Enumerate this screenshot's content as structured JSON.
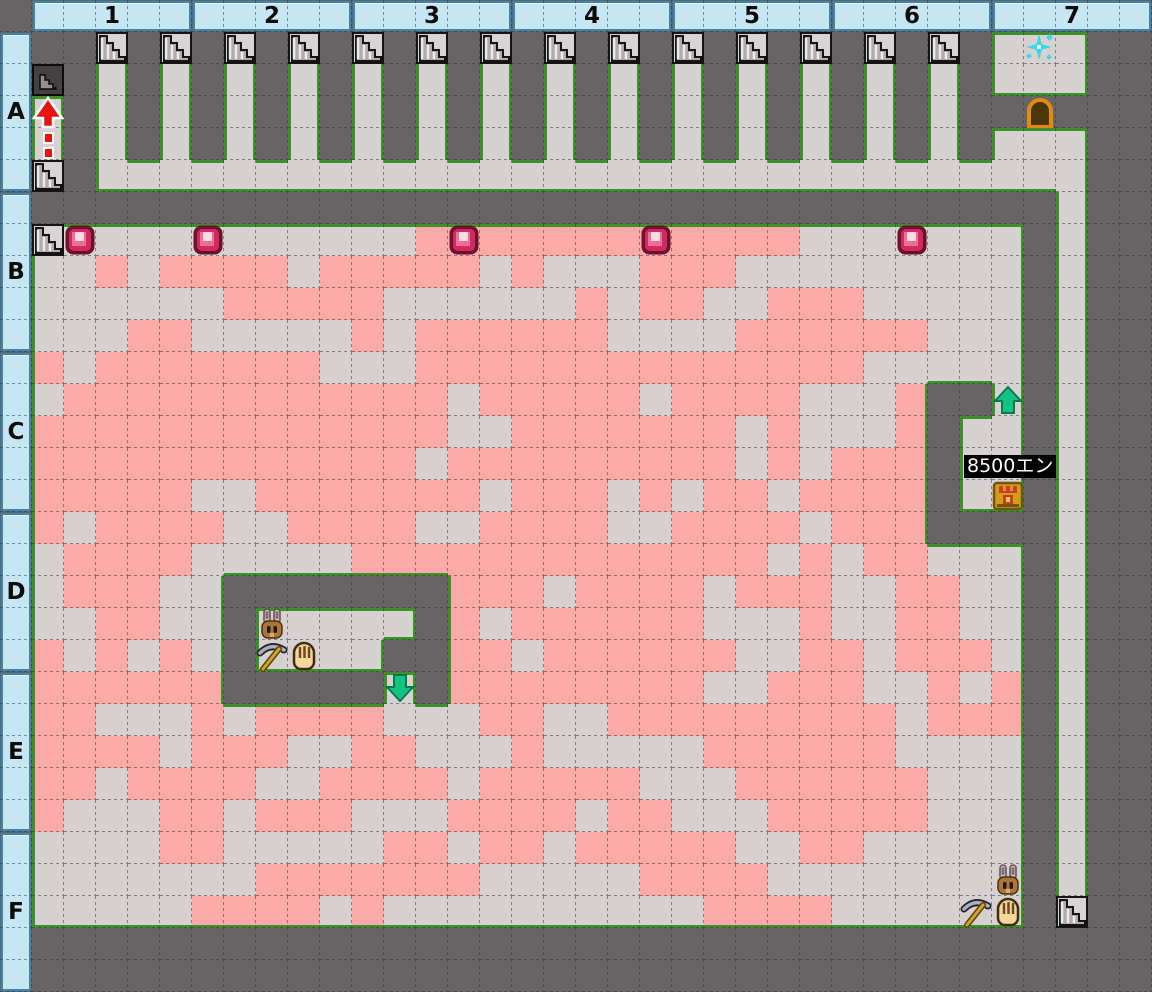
{
  "map": {
    "tile_size": 32,
    "cols": 35,
    "rows": 30,
    "column_headers": [
      "1",
      "2",
      "3",
      "4",
      "5",
      "6",
      "7"
    ],
    "row_headers": [
      "A",
      "B",
      "C",
      "D",
      "E",
      "F"
    ],
    "colors": {
      "wall": "#686465",
      "floor": "#d7d1d1",
      "dug_floor": "#fbaaa8",
      "outline_green": "#3e8e2b",
      "grid_dash": "#2e2e33",
      "header_bg": "#c7e6f3",
      "header_border": "#3a86ad",
      "stairs_bg": "#d9d4d4",
      "stairs_step": "#b4abac",
      "dark_tile": "#454142",
      "gem_dark": "#6e1130",
      "gem_mid": "#d12a5e",
      "gem_light": "#ef6e97",
      "gem_pale": "#f6dce6",
      "arrow_red": "#e81410",
      "arrow_green": "#12c481",
      "arrow_green_edge": "#0a7a4e",
      "chest_gold": "#cf9d18",
      "chest_trim": "#705310",
      "chest_red": "#cf3b2e",
      "door_orange": "#df8d12",
      "door_inner": "#4f350b",
      "sparkle": "#3bd7e8",
      "label_bg": "#000000",
      "label_text": "#ffffff"
    },
    "legend": {
      "#": "wall",
      ".": "floor",
      "p": "dug-floor"
    },
    "tilemap": [
      "###################################",
      "###.#.#.#.#.#.#.#.#.#.#.#.#.#.#...#",
      "###.#.#.#.#.#.#.#.#.#.#.#.#.#.#...#",
      "#.#.#.#.#.#.#.#.#.#.#.#.#.#.#.#####",
      "#.#.#.#.#.#.#.#.#.#.#.#.#.#.#.#...#",
      "#.#...............................#",
      "#################################.#",
      "#............pppppppppppp.......#.#",
      "#..p.pppp.ppppp.p...ppp.........#.#",
      "#......ppppp......p.pp..ppp.....#.#",
      "#...pp.....p.pppppp....pppppp...#.#",
      "#p.ppppppp...pppppppppppppp.....#.#",
      "#.pppppppppppp.ppppp.pppp...p##.#.#",
      "#ppppppppppppp..ppppppp.p...p#..#.#",
      "#pppppppppppp.ppppppppp.p.ppp#..#.#",
      "#ppppp..ppppppp.ppp.p.pp.pppp#..#.#",
      "#p.pppp..pppp..pppp..pppp.ppp####.#",
      "#.pppp.....ppppppppppppp.p.pp...#.#",
      "#.ppp..#######ppp.pppp.ppp..pp..#.#",
      "#..pp..#.....#p.pppppp...p..pp..#.#",
      "#p.p.p.#....##pp.pppppp..pp.ppp.#.#",
      "#pppppp#####.#pppppppp..ppp..p.p#.#",
      "#pp...p.pppp...pp..ppppppppp.ppp#.#",
      "#pppp.ppp..pp...p.....pppppp....#.#",
      "#pp.pppp..pppp.ppppp...pppppp...#.#",
      "#p...pp.ppp...pppp.pp...ppppp...#.#",
      "#....pp.....pp.pp.ppppp..pp.....#.#",
      "#.......ppppppp.....pppp........#.#",
      "#.....pppp.p..........pppp......#.#",
      "###################################"
    ],
    "overlays": [
      {
        "type": "stairs",
        "col": 3,
        "row": 1
      },
      {
        "type": "stairs",
        "col": 5,
        "row": 1
      },
      {
        "type": "stairs",
        "col": 7,
        "row": 1
      },
      {
        "type": "stairs",
        "col": 9,
        "row": 1
      },
      {
        "type": "stairs",
        "col": 11,
        "row": 1
      },
      {
        "type": "stairs",
        "col": 13,
        "row": 1
      },
      {
        "type": "stairs",
        "col": 15,
        "row": 1
      },
      {
        "type": "stairs",
        "col": 17,
        "row": 1
      },
      {
        "type": "stairs",
        "col": 19,
        "row": 1
      },
      {
        "type": "stairs",
        "col": 21,
        "row": 1
      },
      {
        "type": "stairs",
        "col": 23,
        "row": 1
      },
      {
        "type": "stairs",
        "col": 25,
        "row": 1
      },
      {
        "type": "stairs",
        "col": 27,
        "row": 1
      },
      {
        "type": "stairs",
        "col": 29,
        "row": 1
      },
      {
        "type": "stairs",
        "col": 1,
        "row": 5
      },
      {
        "type": "stairs",
        "col": 1,
        "row": 7
      },
      {
        "type": "stairs",
        "col": 33,
        "row": 28
      },
      {
        "type": "stairs-dark",
        "col": 1,
        "row": 2
      },
      {
        "type": "red-arrow",
        "col": 1,
        "row": 3
      },
      {
        "type": "sparkle",
        "col": 32,
        "row": 1
      },
      {
        "type": "door",
        "col": 32,
        "row": 3
      },
      {
        "type": "gem",
        "col": 2,
        "row": 7
      },
      {
        "type": "gem",
        "col": 6,
        "row": 7
      },
      {
        "type": "gem",
        "col": 14,
        "row": 7
      },
      {
        "type": "gem",
        "col": 20,
        "row": 7
      },
      {
        "type": "gem",
        "col": 28,
        "row": 7
      },
      {
        "type": "arrow-up",
        "col": 31,
        "row": 12
      },
      {
        "type": "price-label",
        "col": 30,
        "row": 14,
        "text": "8500エン"
      },
      {
        "type": "chest",
        "col": 31,
        "row": 15
      },
      {
        "type": "rabbit",
        "col": 8,
        "row": 19
      },
      {
        "type": "pickaxe",
        "col": 8,
        "row": 20
      },
      {
        "type": "glove",
        "col": 9,
        "row": 20
      },
      {
        "type": "arrow-down",
        "col": 12,
        "row": 21
      },
      {
        "type": "rabbit",
        "col": 31,
        "row": 27
      },
      {
        "type": "pickaxe",
        "col": 30,
        "row": 28
      },
      {
        "type": "glove",
        "col": 31,
        "row": 28
      }
    ]
  }
}
